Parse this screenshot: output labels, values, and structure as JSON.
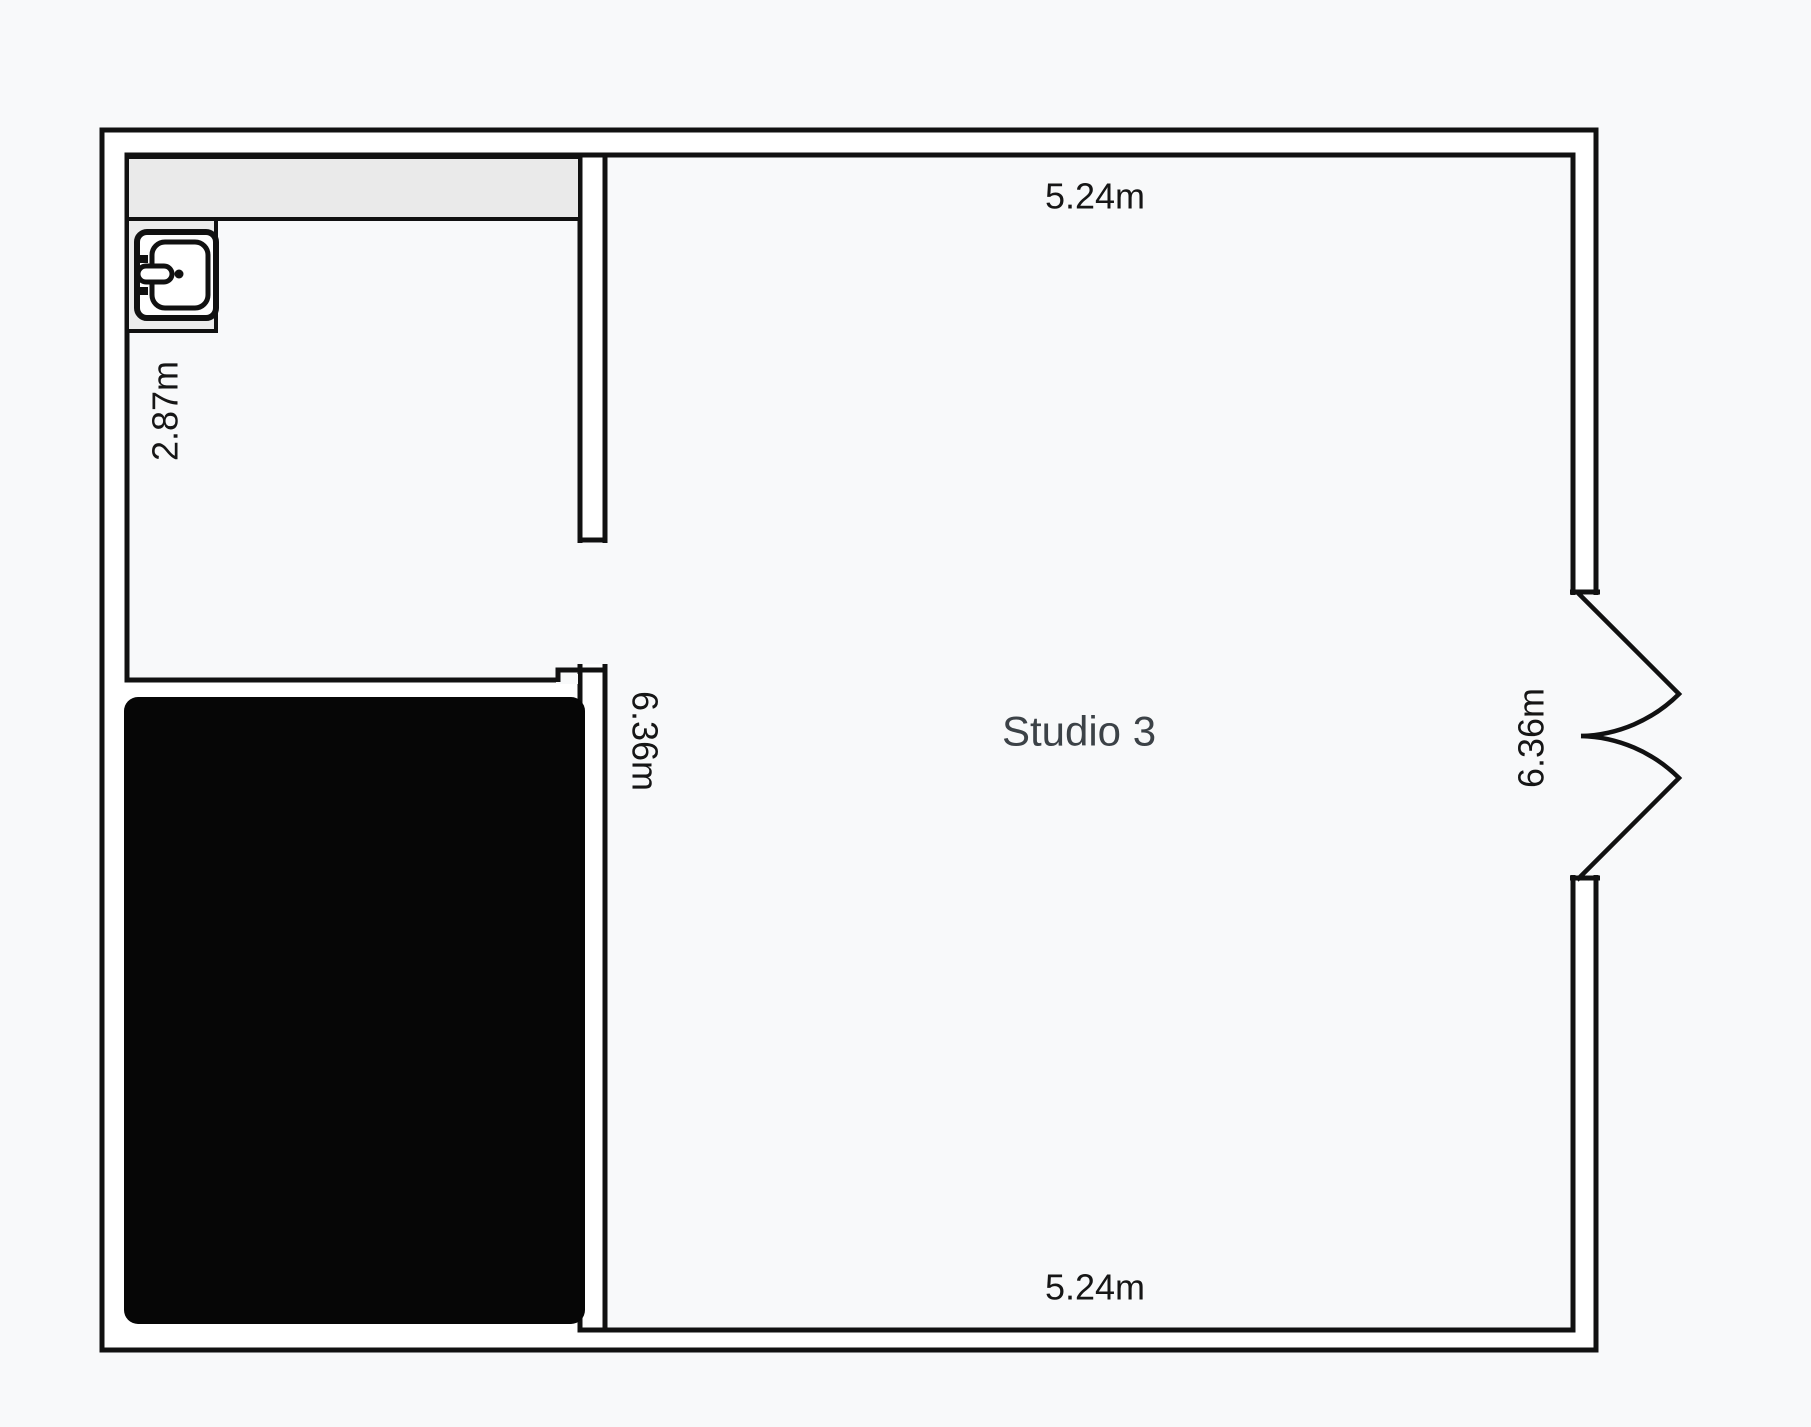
{
  "plan": {
    "room_label": "Studio 3",
    "dimensions": {
      "top_width": "5.24m",
      "bottom_width": "5.24m",
      "inner_left_height": "6.36m",
      "right_height": "6.36m",
      "left_section_width": "2.87m"
    },
    "icons": {
      "sink": "sink-icon"
    },
    "colors": {
      "background": "#f8f9fa",
      "wall_stroke": "#111111",
      "wall_fill": "#ffffff",
      "counter_fill": "#eaeaea",
      "sink_enclosure_fill": "#ececec",
      "blacked_room_fill": "#060606",
      "room_label_color": "#3c4247",
      "dimension_label_color": "#161616"
    }
  }
}
